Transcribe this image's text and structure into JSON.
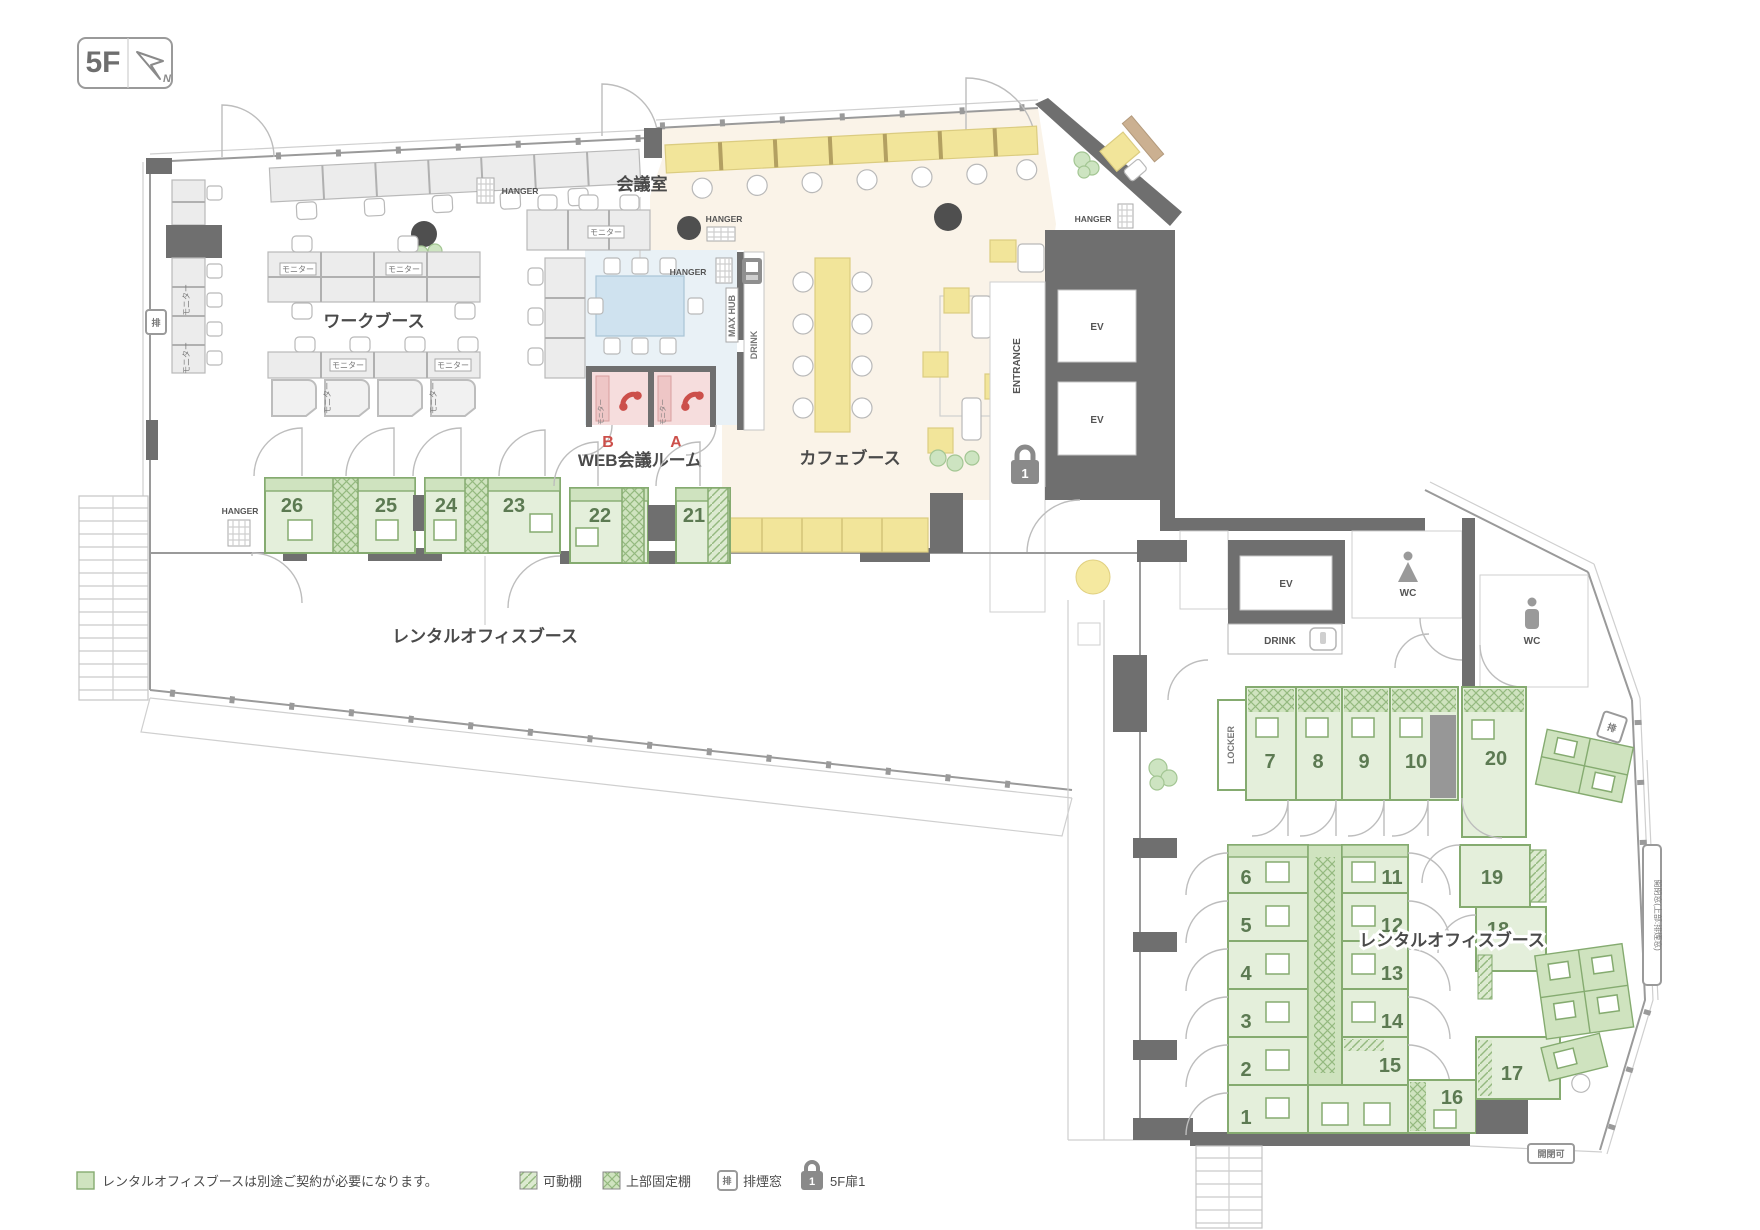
{
  "floor": {
    "badge": "5F",
    "compass_n": "N"
  },
  "rooms": {
    "work_booth": "ワークブース",
    "meeting": "会議室",
    "web_meeting": "WEB会議ルーム",
    "cafe": "カフェブース",
    "rental_office_upper": "レンタルオフィスブース",
    "rental_office_lower": "レンタルオフィスブース"
  },
  "labels": {
    "monitor": "モニター",
    "hanger": "HANGER",
    "ev": "EV",
    "wc": "WC",
    "drink": "DRINK",
    "max_hub": "MAX HUB",
    "entrance": "ENTRANCE",
    "locker": "LOCKER",
    "smoke": "排",
    "open_window": "開閉窓(上部:排煙窓)",
    "openable": "開閉可",
    "door_lock_number": "1"
  },
  "web_booths": {
    "b": "B",
    "a": "A"
  },
  "booths": {
    "upper": [
      "26",
      "25",
      "24",
      "23",
      "22",
      "21"
    ],
    "lower_top": [
      "7",
      "8",
      "9",
      "10",
      "20"
    ],
    "lower_left": [
      "6",
      "5",
      "4",
      "3",
      "2",
      "1"
    ],
    "lower_center": [
      "11",
      "12",
      "13",
      "14",
      "15",
      "16"
    ],
    "lower_right": [
      "19",
      "18",
      "17"
    ]
  },
  "legend": {
    "note": "レンタルオフィスブースは別途ご契約が必要になります。",
    "movable_shelf": "可動棚",
    "fixed_shelf": "上部固定棚",
    "smoke_window": "排煙窓",
    "door": "5F扉1"
  },
  "colors": {
    "booth_green": "#cfe3bf",
    "booth_green_light": "#e4efdb",
    "green_border": "#85ab70",
    "cafe_cream": "#faf3e8",
    "furniture_yellow": "#f2e59a",
    "meeting_blue": "#e9f1f6",
    "web_pink": "#f6dddd",
    "phone_red": "#cc4f4a",
    "wall_dark": "#6f6f6f",
    "number_green": "#5c7a52"
  }
}
